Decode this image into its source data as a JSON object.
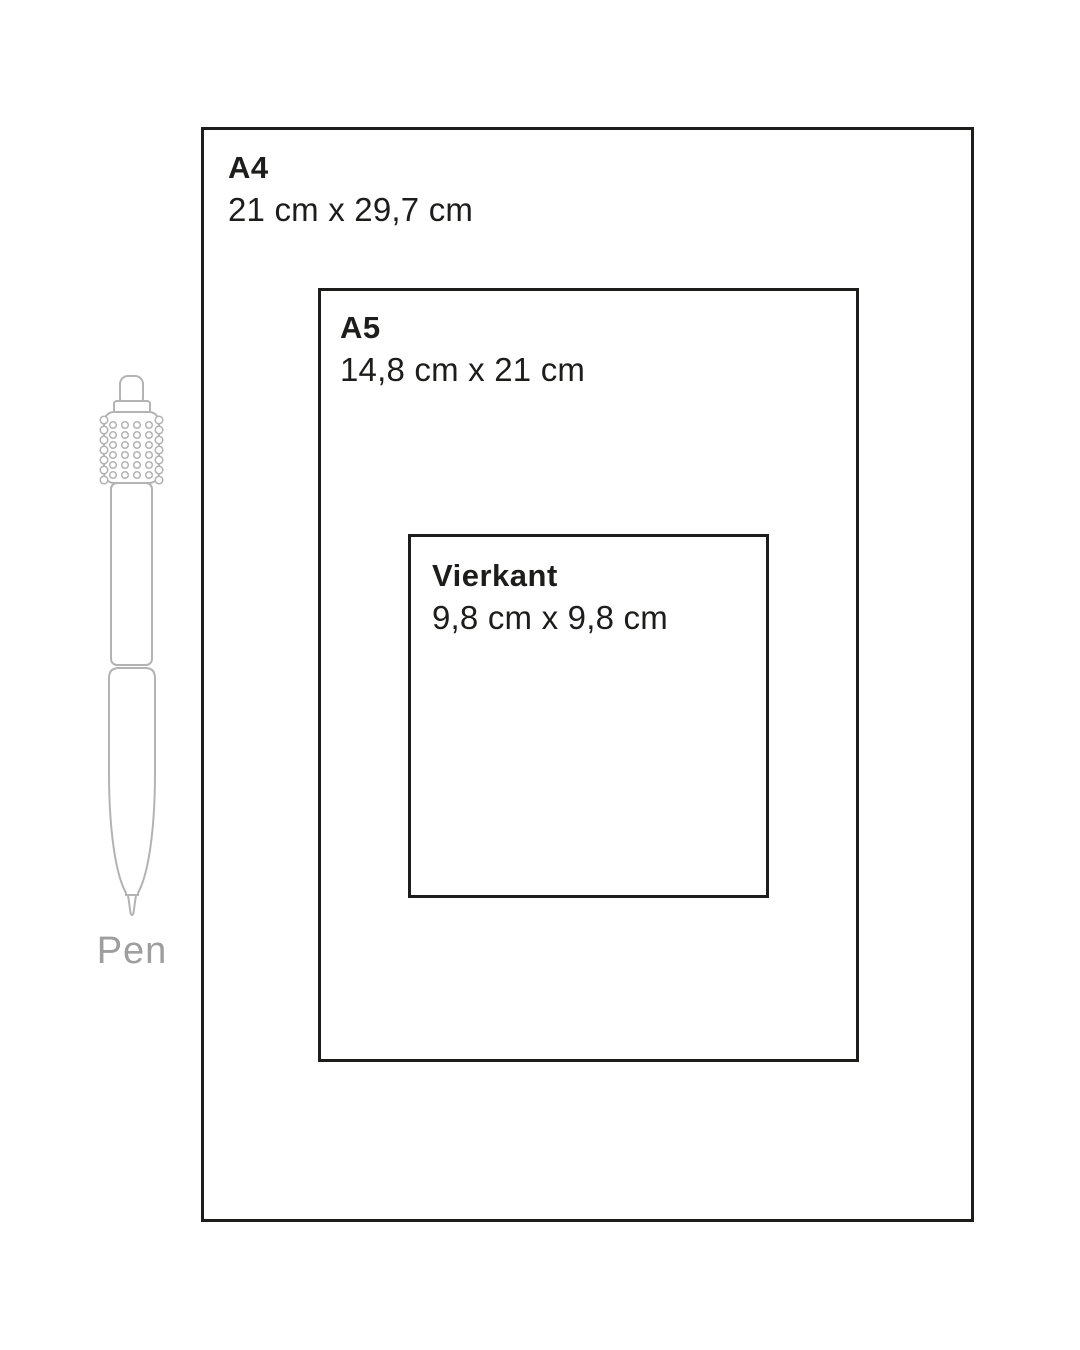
{
  "diagram": {
    "type": "size-comparison",
    "background": "#ffffff",
    "outline_color": "#1d1d1b",
    "pen_outline_color": "#b3b3b3",
    "pen_label_color": "#9e9e9e"
  },
  "sizes": [
    {
      "id": "a4",
      "label": "A4",
      "dimensions": "21 cm x 29,7 cm"
    },
    {
      "id": "a5",
      "label": "A5",
      "dimensions": "14,8 cm x 21 cm"
    },
    {
      "id": "vierkant",
      "label": "Vierkant",
      "dimensions": "9,8 cm x 9,8 cm"
    }
  ],
  "pen": {
    "label": "Pen"
  }
}
